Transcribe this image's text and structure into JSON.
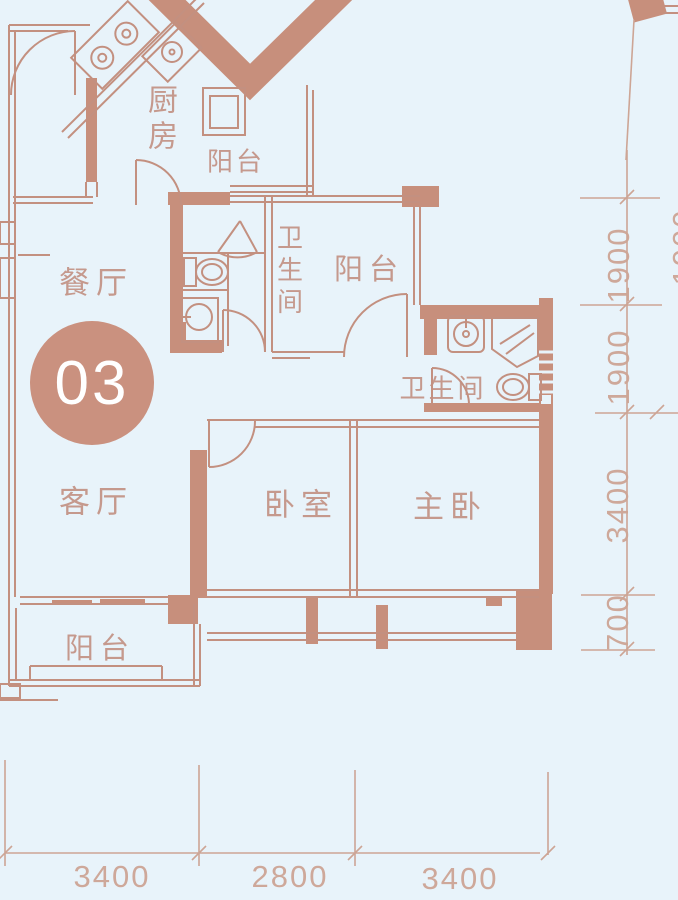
{
  "palette": {
    "background": "#e8f3fa",
    "line": "#c39080",
    "wall_fill": "#c78f7c",
    "label_text": "#c29082",
    "dimension_text": "#cda595",
    "badge_fill": "#ca917f",
    "badge_text": "#ffffff"
  },
  "unit_badge": {
    "number": "03"
  },
  "rooms": {
    "kitchen": {
      "label": "厨房"
    },
    "kitchen_balcony": {
      "label": "阳台"
    },
    "dining": {
      "label": "餐厅"
    },
    "bathroom_shared": {
      "label": "卫生间"
    },
    "rear_balcony": {
      "label": "阳台"
    },
    "bathroom_ensuite": {
      "label": "卫生间"
    },
    "living": {
      "label": "客厅"
    },
    "bedroom": {
      "label": "卧室"
    },
    "master_bedroom": {
      "label": "主卧"
    },
    "front_balcony": {
      "label": "阳台"
    }
  },
  "dimensions": {
    "right": [
      {
        "value": "1900"
      },
      {
        "value": "1900"
      },
      {
        "value": "3400"
      },
      {
        "value": "700"
      }
    ],
    "right_partial": {
      "value": "1900"
    },
    "bottom": [
      {
        "value": "3400"
      },
      {
        "value": "2800"
      },
      {
        "value": "3400"
      }
    ]
  }
}
